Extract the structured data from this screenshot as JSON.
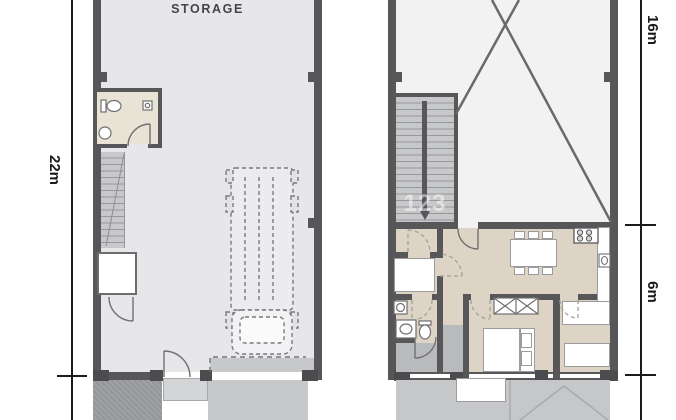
{
  "plans": {
    "left": {
      "label": "STORAGE",
      "features": [
        "bathroom",
        "staircase",
        "utility-closet",
        "truck-parking-bay",
        "entrance-door",
        "garage-opening",
        "driveway",
        "dark-terrace"
      ]
    },
    "right": {
      "features": [
        "void-cross",
        "staircase-double-flight",
        "storage-room",
        "bathroom",
        "entry-hall",
        "living-dining",
        "kitchen",
        "wardrobe",
        "bedroom-1",
        "bedroom-2",
        "terrace",
        "parking-marks"
      ]
    }
  },
  "dimensions": {
    "left": "22m",
    "right_upper": "16m",
    "right_lower": "6m"
  },
  "watermark": "123",
  "colors": {
    "wall": "#57575a",
    "wall_dark": "#4c4c4f",
    "floor_storage": "#e7e7e9",
    "floor_void": "#f2f2f3",
    "floor_living": "#ddd4c5",
    "floor_wet": "#e9e3d5",
    "stairs": "#c7c8ca",
    "step_line": "#98989b",
    "entry_grey": "#b9babc",
    "terrace": "#c6c7c9",
    "terrace_dark": "#a0a1a3",
    "driveway": "#c7c8ca",
    "furn_border": "#9b9b9d",
    "dim": "#1b1b1d",
    "text": "#454547"
  }
}
